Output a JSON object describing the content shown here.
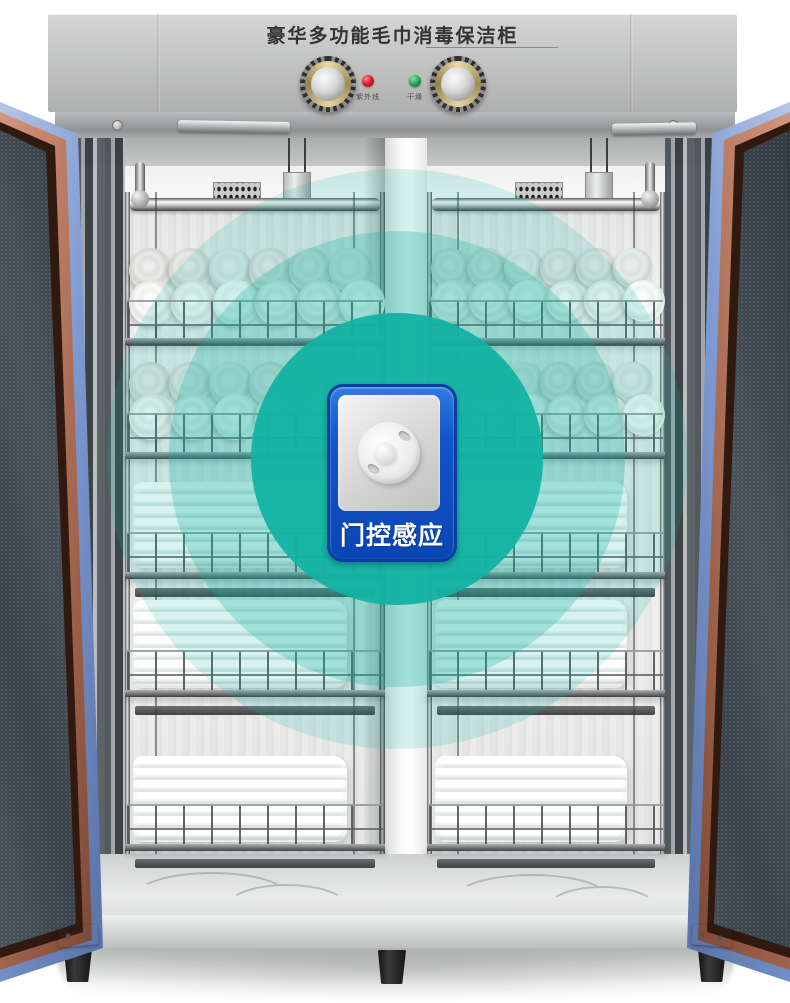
{
  "scene": {
    "description": "Double-door stainless steel towel disinfection cabinet with open mesh doors, wire shelves of rolled and folded towels, and a door-sensor feature callout",
    "background_color": "#ffffff"
  },
  "cabinet": {
    "title": "豪华多功能毛巾消毒保洁柜",
    "panel": {
      "knobs": [
        {
          "name": "left-control-knob"
        },
        {
          "name": "right-control-knob"
        }
      ],
      "indicators": [
        {
          "name": "uv-indicator",
          "label": "紫外线",
          "color": "#df1527"
        },
        {
          "name": "dry-indicator",
          "label": "干燥",
          "color": "#18a048"
        }
      ]
    },
    "door_colors": {
      "trim_blue": "#7e9ad2",
      "frame_copper": "#a96a52",
      "mesh": "#39424a"
    },
    "feet_count": 3
  },
  "interior": {
    "compartments": [
      "left",
      "right"
    ],
    "shelves": [
      {
        "row": 1,
        "contents": "rolled-towels"
      },
      {
        "row": 2,
        "contents": "rolled-towels"
      },
      {
        "row": 3,
        "contents": "folded-towels"
      },
      {
        "row": 4,
        "contents": "folded-towels"
      },
      {
        "row": 5,
        "contents": "folded-towels"
      }
    ]
  },
  "overlay": {
    "label": "门控感应",
    "ring_color": "#12b2a2",
    "badge_color": "#0a46b4"
  }
}
